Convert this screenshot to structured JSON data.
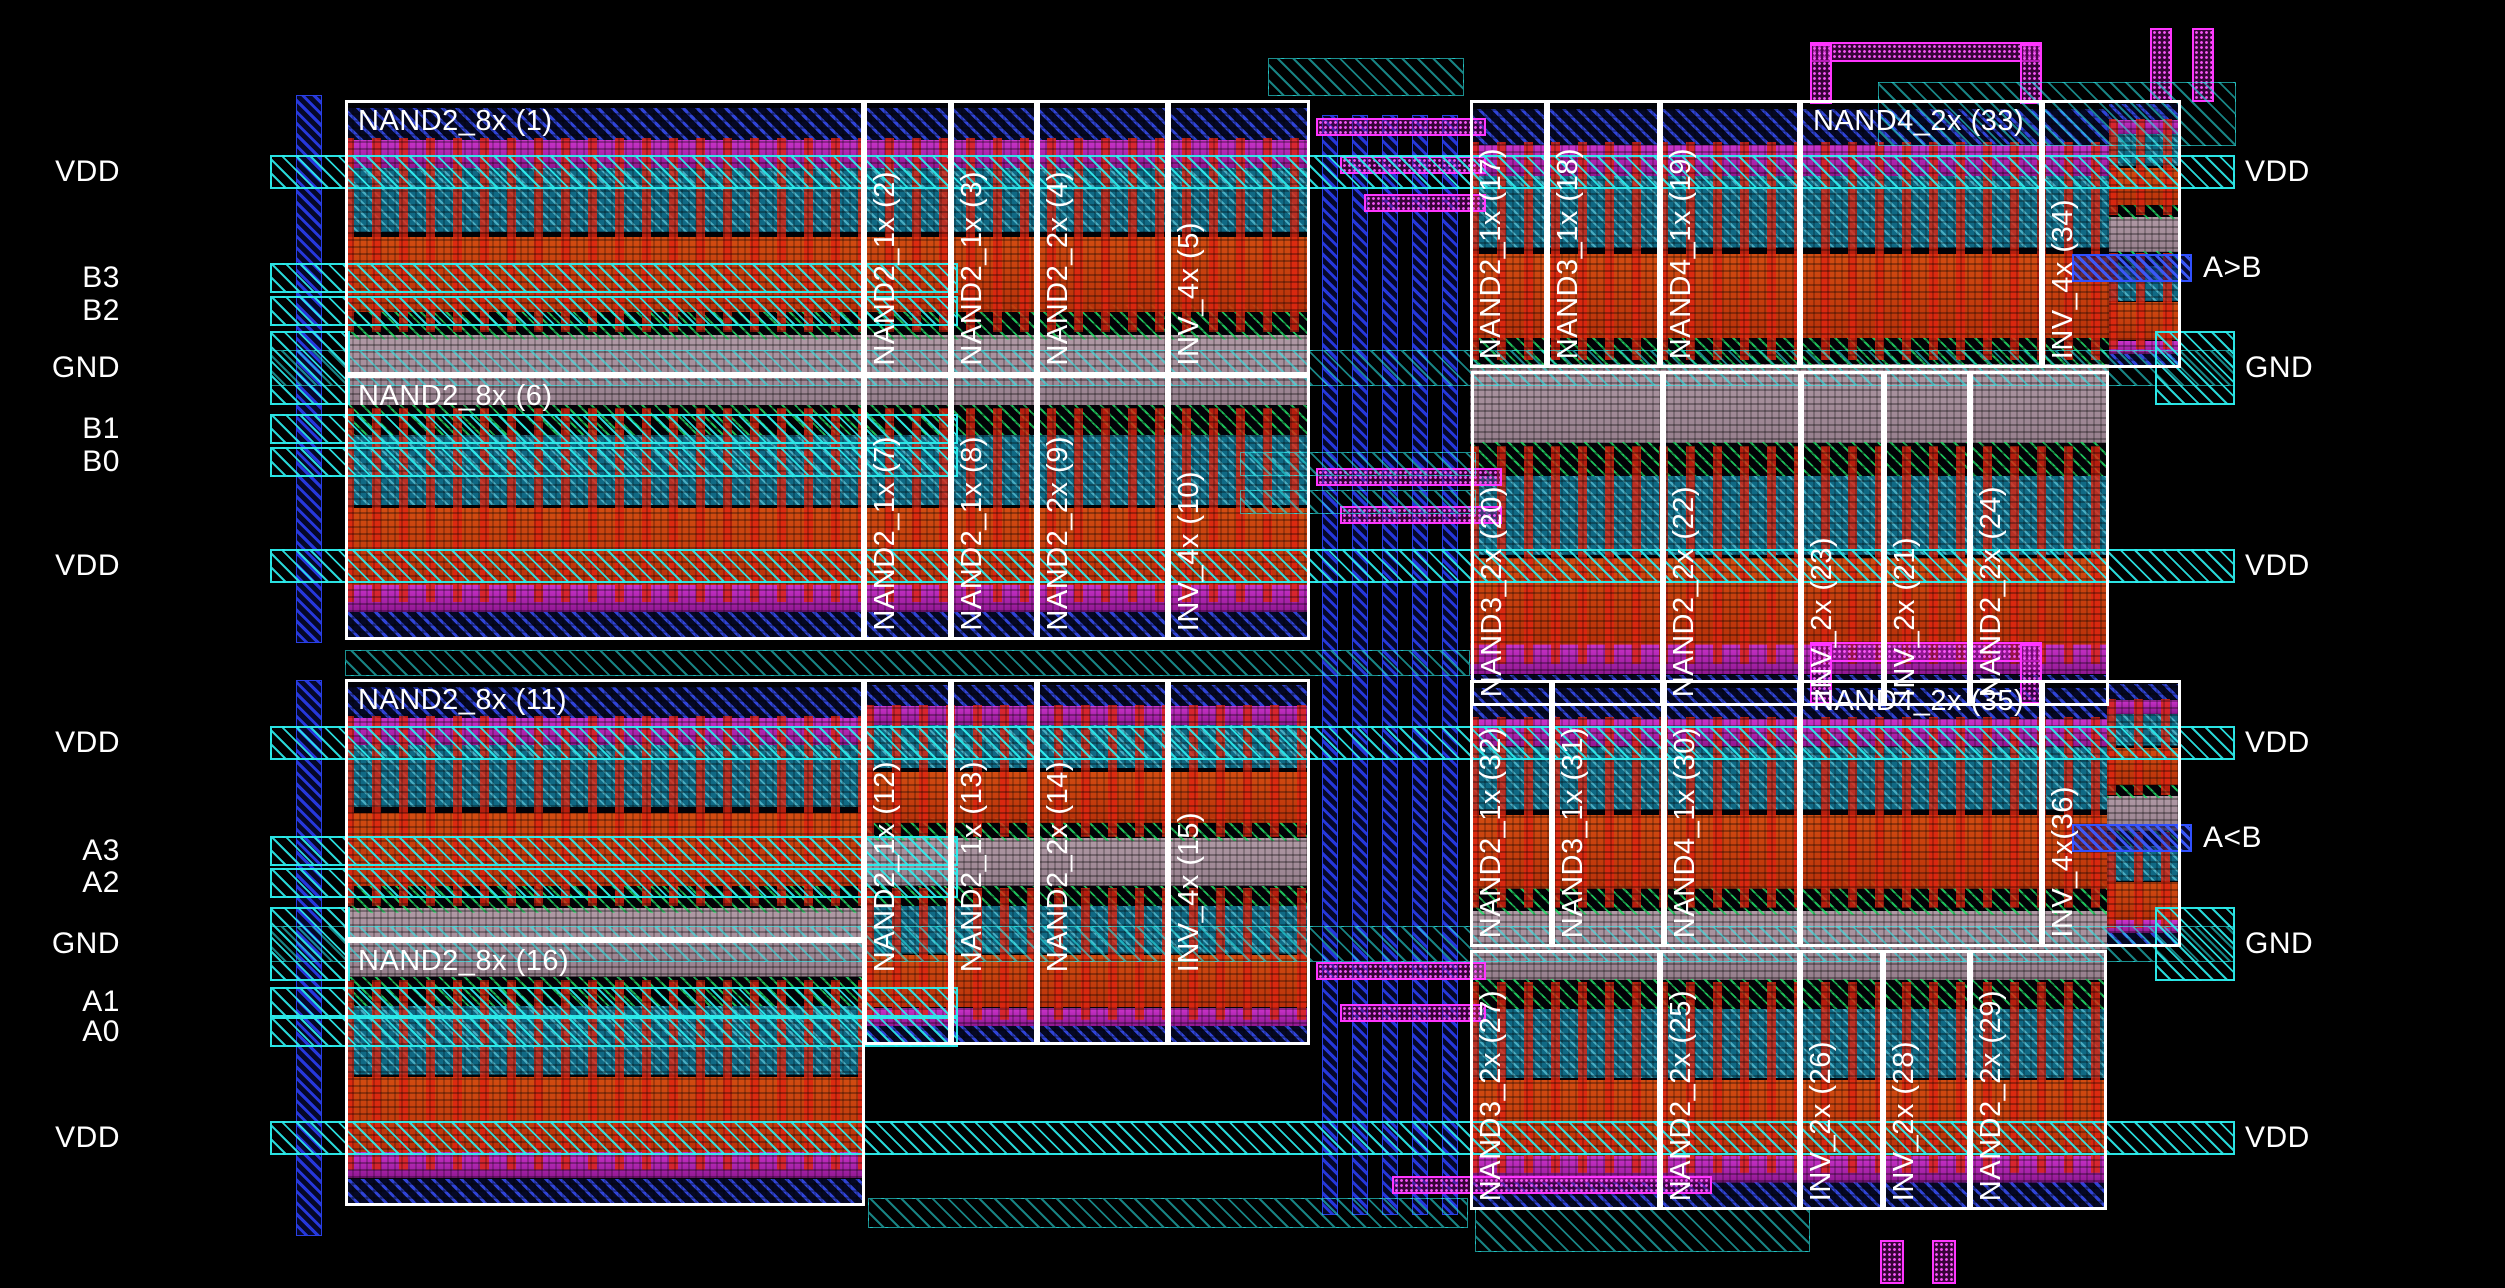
{
  "canvas": {
    "width": 2505,
    "height": 1288,
    "background": "#000000"
  },
  "colors": {
    "cell_outline": "#ffffff",
    "label_text": "#ffffff",
    "power_rail": "#2ceeee",
    "output_rail": "#3050ff",
    "gate_stripe": "#de2410",
    "pmos_band": "#117492",
    "diffusion_band": "#cd3e0c",
    "gnd_band": "#b6a2ae",
    "well_hatch": "#24e068",
    "contact_strip": "#e23ce2",
    "routing_wire": "#ff35ff",
    "channel_wire": "#2838e6"
  },
  "ports_left": [
    {
      "label": "VDD",
      "y": 172,
      "kind": "vdd"
    },
    {
      "label": "B3",
      "y": 278,
      "kind": "in"
    },
    {
      "label": "B2",
      "y": 311,
      "kind": "in"
    },
    {
      "label": "GND",
      "y": 368,
      "kind": "gnd"
    },
    {
      "label": "B1",
      "y": 429,
      "kind": "in"
    },
    {
      "label": "B0",
      "y": 462,
      "kind": "in"
    },
    {
      "label": "VDD",
      "y": 566,
      "kind": "vdd"
    },
    {
      "label": "VDD",
      "y": 743,
      "kind": "vdd"
    },
    {
      "label": "A3",
      "y": 851,
      "kind": "in"
    },
    {
      "label": "A2",
      "y": 883,
      "kind": "in"
    },
    {
      "label": "GND",
      "y": 944,
      "kind": "gnd"
    },
    {
      "label": "A1",
      "y": 1002,
      "kind": "in"
    },
    {
      "label": "A0",
      "y": 1032,
      "kind": "in"
    },
    {
      "label": "VDD",
      "y": 1138,
      "kind": "vdd"
    }
  ],
  "ports_right": [
    {
      "label": "VDD",
      "y": 172,
      "kind": "vdd"
    },
    {
      "label": "A>B",
      "y": 268,
      "kind": "out"
    },
    {
      "label": "GND",
      "y": 368,
      "kind": "gnd"
    },
    {
      "label": "VDD",
      "y": 566,
      "kind": "vdd"
    },
    {
      "label": "VDD",
      "y": 743,
      "kind": "vdd"
    },
    {
      "label": "A<B",
      "y": 838,
      "kind": "out"
    },
    {
      "label": "GND",
      "y": 944,
      "kind": "gnd"
    },
    {
      "label": "VDD",
      "y": 1138,
      "kind": "vdd"
    }
  ],
  "pattern_blocks": [
    {
      "x": 345,
      "y": 100,
      "w": 965,
      "h": 540
    },
    {
      "x": 345,
      "y": 679,
      "w": 520,
      "h": 527
    },
    {
      "x": 865,
      "y": 679,
      "w": 445,
      "h": 366
    },
    {
      "x": 1470,
      "y": 100,
      "w": 639,
      "h": 606
    },
    {
      "x": 2109,
      "y": 100,
      "w": 72,
      "h": 268
    },
    {
      "x": 1470,
      "y": 680,
      "w": 637,
      "h": 530
    },
    {
      "x": 2107,
      "y": 680,
      "w": 74,
      "h": 267
    }
  ],
  "cells": [
    {
      "label": "NAND2_8x (1)",
      "x": 345,
      "y": 100,
      "w": 519,
      "h": 275,
      "rot": false
    },
    {
      "label": "NAND2_1x (2)",
      "x": 864,
      "y": 100,
      "w": 87,
      "h": 275,
      "rot": true
    },
    {
      "label": "NAND2_1x (3)",
      "x": 951,
      "y": 100,
      "w": 86,
      "h": 275,
      "rot": true
    },
    {
      "label": "NAND2_2x (4)",
      "x": 1037,
      "y": 100,
      "w": 131,
      "h": 275,
      "rot": true
    },
    {
      "label": "INV_4x (5)",
      "x": 1168,
      "y": 100,
      "w": 142,
      "h": 275,
      "rot": true
    },
    {
      "label": "NAND2_8x (6)",
      "x": 345,
      "y": 375,
      "w": 519,
      "h": 265,
      "rot": false
    },
    {
      "label": "NAND2_1x (7)",
      "x": 864,
      "y": 375,
      "w": 87,
      "h": 265,
      "rot": true
    },
    {
      "label": "NAND2_1x (8)",
      "x": 951,
      "y": 375,
      "w": 86,
      "h": 265,
      "rot": true
    },
    {
      "label": "NAND2_2x (9)",
      "x": 1037,
      "y": 375,
      "w": 131,
      "h": 265,
      "rot": true
    },
    {
      "label": "INV_4x (10)",
      "x": 1168,
      "y": 375,
      "w": 142,
      "h": 265,
      "rot": true
    },
    {
      "label": "NAND2_8x (11)",
      "x": 345,
      "y": 679,
      "w": 519,
      "h": 261,
      "rot": false
    },
    {
      "label": "NAND2_1x (12)",
      "x": 864,
      "y": 679,
      "w": 87,
      "h": 366,
      "rot": true,
      "lb": 70
    },
    {
      "label": "NAND2_1x (13)",
      "x": 951,
      "y": 679,
      "w": 86,
      "h": 366,
      "rot": true,
      "lb": 70
    },
    {
      "label": "NAND2_2x (14)",
      "x": 1037,
      "y": 679,
      "w": 131,
      "h": 366,
      "rot": true,
      "lb": 70
    },
    {
      "label": "INV_4x (15)",
      "x": 1168,
      "y": 679,
      "w": 142,
      "h": 366,
      "rot": true,
      "lb": 70
    },
    {
      "label": "NAND2_8x (16)",
      "x": 345,
      "y": 940,
      "w": 520,
      "h": 266,
      "rot": false
    },
    {
      "label": "NAND2_1x (17)",
      "x": 1470,
      "y": 100,
      "w": 77,
      "h": 268,
      "rot": true
    },
    {
      "label": "NAND3_1x (18)",
      "x": 1547,
      "y": 100,
      "w": 113,
      "h": 268,
      "rot": true
    },
    {
      "label": "NAND4_1x (19)",
      "x": 1660,
      "y": 100,
      "w": 140,
      "h": 268,
      "rot": true
    },
    {
      "label": "NAND4_2x (33)",
      "x": 1800,
      "y": 100,
      "w": 242,
      "h": 268,
      "rot": false
    },
    {
      "label": "INV_4x (34)",
      "x": 2042,
      "y": 100,
      "w": 139,
      "h": 268,
      "rot": true
    },
    {
      "label": "NAND3_2x (20)",
      "x": 1471,
      "y": 371,
      "w": 192,
      "h": 335,
      "rot": true
    },
    {
      "label": "NAND2_2x (22)",
      "x": 1663,
      "y": 371,
      "w": 138,
      "h": 335,
      "rot": true
    },
    {
      "label": "INV_2x (23)",
      "x": 1801,
      "y": 371,
      "w": 83,
      "h": 335,
      "rot": true
    },
    {
      "label": "INV_2x (21)",
      "x": 1884,
      "y": 371,
      "w": 86,
      "h": 335,
      "rot": true
    },
    {
      "label": "NAND2_2x (24)",
      "x": 1970,
      "y": 371,
      "w": 139,
      "h": 335,
      "rot": true
    },
    {
      "label": "NAND2_1x (32)",
      "x": 1470,
      "y": 680,
      "w": 82,
      "h": 267,
      "rot": true
    },
    {
      "label": "NAND3_1x (31)",
      "x": 1552,
      "y": 680,
      "w": 112,
      "h": 267,
      "rot": true
    },
    {
      "label": "NAND4_1x (30)",
      "x": 1664,
      "y": 680,
      "w": 136,
      "h": 267,
      "rot": true
    },
    {
      "label": "NAND4_2x (35)",
      "x": 1800,
      "y": 680,
      "w": 242,
      "h": 267,
      "rot": false
    },
    {
      "label": "INV_4x(36)",
      "x": 2042,
      "y": 680,
      "w": 139,
      "h": 267,
      "rot": true
    },
    {
      "label": "NAND3_2x (27)",
      "x": 1470,
      "y": 950,
      "w": 190,
      "h": 260,
      "rot": true
    },
    {
      "label": "NAND2_2x (25)",
      "x": 1660,
      "y": 950,
      "w": 140,
      "h": 260,
      "rot": true
    },
    {
      "label": "INV_2x (26)",
      "x": 1800,
      "y": 950,
      "w": 83,
      "h": 260,
      "rot": true
    },
    {
      "label": "INV_2x (28)",
      "x": 1883,
      "y": 950,
      "w": 87,
      "h": 260,
      "rot": true
    },
    {
      "label": "NAND2_2x (29)",
      "x": 1970,
      "y": 950,
      "w": 137,
      "h": 260,
      "rot": true
    }
  ],
  "wires": [
    {
      "t": "bluev",
      "x": 1322,
      "y": 115,
      "w": 16,
      "h": 1100
    },
    {
      "t": "bluev",
      "x": 1352,
      "y": 115,
      "w": 16,
      "h": 1100
    },
    {
      "t": "bluev",
      "x": 1382,
      "y": 115,
      "w": 16,
      "h": 1100
    },
    {
      "t": "bluev",
      "x": 1412,
      "y": 115,
      "w": 16,
      "h": 1100
    },
    {
      "t": "bluev",
      "x": 1442,
      "y": 115,
      "w": 16,
      "h": 1100
    },
    {
      "t": "bluev",
      "x": 296,
      "y": 95,
      "w": 26,
      "h": 548
    },
    {
      "t": "bluev",
      "x": 296,
      "y": 680,
      "w": 26,
      "h": 556
    },
    {
      "t": "mag",
      "x": 1316,
      "y": 118,
      "w": 170,
      "h": 18
    },
    {
      "t": "mag",
      "x": 1340,
      "y": 156,
      "w": 146,
      "h": 18
    },
    {
      "t": "mag",
      "x": 1364,
      "y": 194,
      "w": 122,
      "h": 18
    },
    {
      "t": "mag",
      "x": 1316,
      "y": 468,
      "w": 186,
      "h": 18
    },
    {
      "t": "mag",
      "x": 1340,
      "y": 506,
      "w": 162,
      "h": 18
    },
    {
      "t": "mag",
      "x": 1316,
      "y": 962,
      "w": 170,
      "h": 18
    },
    {
      "t": "mag",
      "x": 1340,
      "y": 1004,
      "w": 146,
      "h": 18
    },
    {
      "t": "mag",
      "x": 1392,
      "y": 1176,
      "w": 320,
      "h": 18
    },
    {
      "t": "mag",
      "x": 1810,
      "y": 42,
      "w": 232,
      "h": 20
    },
    {
      "t": "mag",
      "x": 1810,
      "y": 44,
      "w": 22,
      "h": 60
    },
    {
      "t": "mag",
      "x": 2020,
      "y": 44,
      "w": 22,
      "h": 60
    },
    {
      "t": "mag",
      "x": 1810,
      "y": 642,
      "w": 232,
      "h": 20
    },
    {
      "t": "mag",
      "x": 1810,
      "y": 644,
      "w": 22,
      "h": 60
    },
    {
      "t": "mag",
      "x": 2020,
      "y": 644,
      "w": 22,
      "h": 60
    },
    {
      "t": "mag",
      "x": 2150,
      "y": 28,
      "w": 22,
      "h": 74
    },
    {
      "t": "mag",
      "x": 2192,
      "y": 28,
      "w": 22,
      "h": 74
    },
    {
      "t": "mag",
      "x": 1880,
      "y": 1240,
      "w": 24,
      "h": 44
    },
    {
      "t": "mag",
      "x": 1932,
      "y": 1240,
      "w": 24,
      "h": 44
    },
    {
      "t": "cyan",
      "x": 1268,
      "y": 58,
      "w": 196,
      "h": 38
    },
    {
      "t": "cyan",
      "x": 1878,
      "y": 82,
      "w": 358,
      "h": 64
    },
    {
      "t": "cyan",
      "x": 345,
      "y": 650,
      "w": 1125,
      "h": 26
    },
    {
      "t": "cyan",
      "x": 1475,
      "y": 1208,
      "w": 335,
      "h": 44
    },
    {
      "t": "cyan",
      "x": 868,
      "y": 1198,
      "w": 600,
      "h": 30
    },
    {
      "t": "cyan",
      "x": 1240,
      "y": 452,
      "w": 236,
      "h": 24
    },
    {
      "t": "cyan",
      "x": 1240,
      "y": 490,
      "w": 236,
      "h": 24
    }
  ],
  "rail_geometry": {
    "vdd": {
      "x": 270,
      "w": 1965,
      "h": 34
    },
    "gnd_stub_left": {
      "x": 270,
      "w": 80,
      "h": 74
    },
    "gnd_stub_right": {
      "x": 2155,
      "w": 80,
      "h": 74
    },
    "gnd_cross": {
      "x": 270,
      "w": 1965,
      "h": 36
    },
    "input": {
      "x": 270,
      "w": 688,
      "h": 30
    },
    "output": {
      "x": 2072,
      "w": 120,
      "h": 28
    },
    "label_left_right_edge": 260,
    "label_right_out_x": 2203,
    "label_right_power_x": 2245
  }
}
